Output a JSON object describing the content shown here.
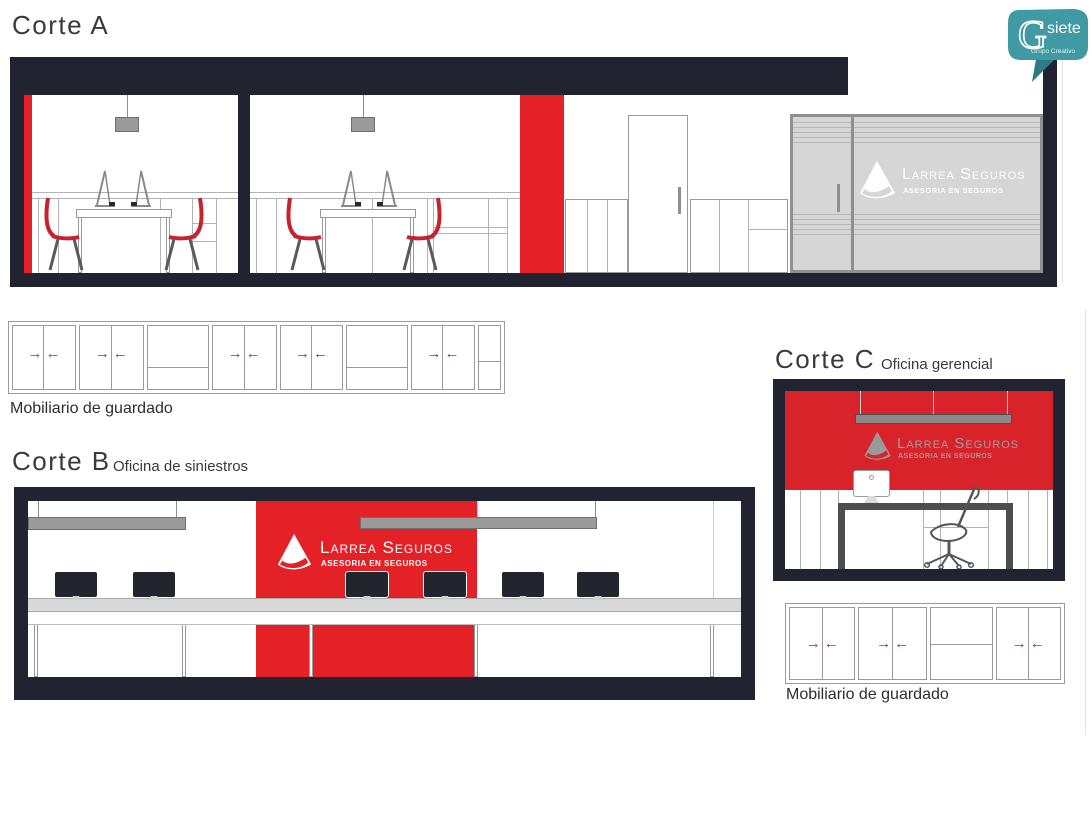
{
  "brand": {
    "logo_text": "Larrea Seguros",
    "tagline": "ASESORIA EN SEGUROS"
  },
  "sections": {
    "corte_a": {
      "title": "Corte A"
    },
    "corte_b": {
      "title": "Corte B",
      "subtitle": "Oficina de siniestros"
    },
    "corte_c": {
      "title": "Corte C",
      "subtitle": "Oficina gerencial"
    }
  },
  "cabinets": {
    "top": {
      "label": "Mobiliario de guardado"
    },
    "bottom": {
      "label": "Mobiliario de guardado"
    }
  },
  "glyphs": {
    "arrow_right": "→",
    "arrow_left": "←"
  },
  "gsiete": {
    "initial": "G",
    "name_rest": "siete",
    "tagline": "Grupo Creativo"
  },
  "colors": {
    "accent_red": "#e32127",
    "accent_red_deep": "#d8232a",
    "frame_dark": "#212430",
    "glass_gray": "#d6d6d6",
    "fixture_gray": "#9a9a9a",
    "arrow_red": "#9c352c",
    "chair_red": "#c8202f",
    "gsiete_teal": "#3f9aa3"
  }
}
